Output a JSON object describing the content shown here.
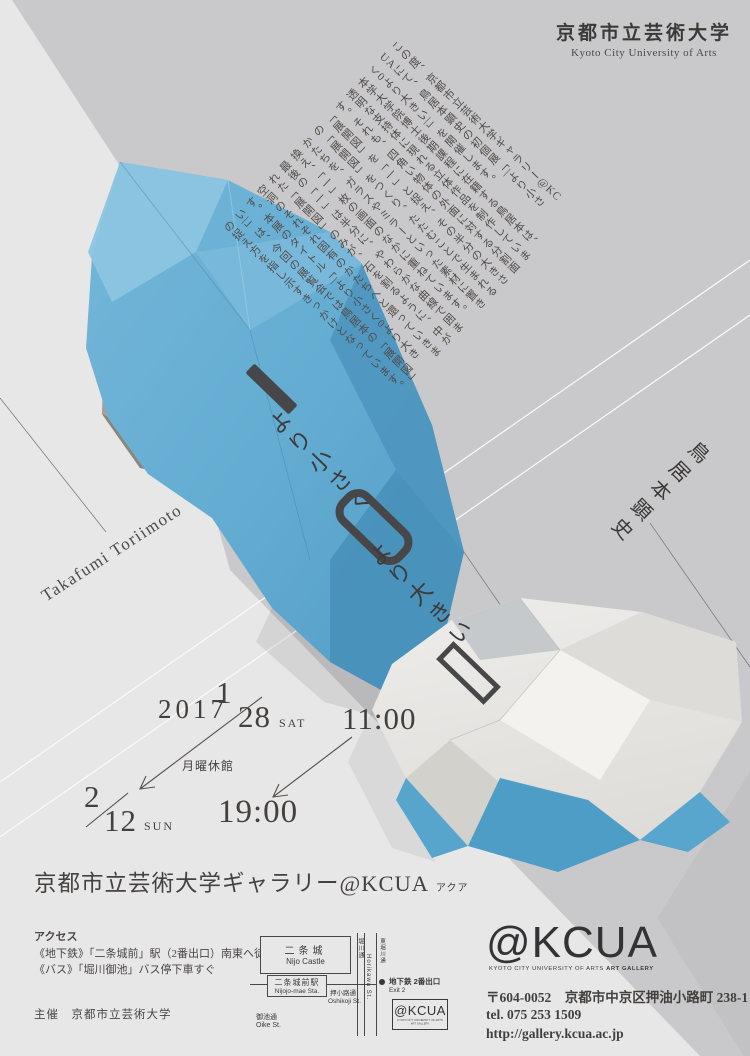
{
  "university": {
    "logo_ja": "京都市立芸術大学",
    "logo_en": "Kyoto City University of Arts"
  },
  "artist": {
    "name_ja": "鳥居本顕史",
    "name_en": "Takafumi Toriimoto"
  },
  "title": {
    "small": "より小さく",
    "large": "より大きい",
    "ring_glyph": "0",
    "bar_glyph": "|"
  },
  "statement": {
    "text": "この度、京都市立芸術大学ギャラリー@KC\nUAにて、鳥居本顕史の初個展「|より小さ\nく0より大きい|」を開催します。\n本学大学院博士後期課程に在籍する鳥居本は、\n透明な支持体に現れる立体作品を制作していま\nす。それも、四角い物体の外面に対する分割面\n「展開図」を「一」と捉え、その半分の大きさ\nの「展開図」をつくり、たたむことで生まれる\nかたちを、ガラスやミラーといった素材に置き\n換え、「一」枚の画面のなかに重ねています。\n最後の「一」は半分に、やわらかな曲線で囲ま\nれた「展開図」のみが、石を割るように、中が\n空洞のそれぞれ固有のかたちへと還っていきま\nす。本展のタイトル「|より小さく0より大き\nい|」は、今回の展覧会では鳥居本の「展開図」\nの捉え方を指し示すきっかけとなっています。"
  },
  "dates": {
    "year": "2017",
    "start_month": "1",
    "start_day": "28",
    "start_dow": "SAT",
    "open_time": "11:00",
    "closed_note": "月曜休館",
    "end_month": "2",
    "end_day": "12",
    "end_dow": "SUN",
    "close_time": "19:00"
  },
  "venue": {
    "name": "京都市立芸術大学ギャラリー@KCUA",
    "ruby": "アクア"
  },
  "access": {
    "heading": "アクセス",
    "lines": [
      "《地下鉄》「二条城前」駅（2番出口）南東へ徒歩約3分",
      "《バス》「堀川御池」バス停下車すぐ"
    ],
    "organizer": "主催　京都市立芸術大学"
  },
  "map": {
    "castle_ja": "二条城",
    "castle_en": "Nijo Castle",
    "station_ja": "二条城前駅",
    "station_en": "Nijojo-mae Sta.",
    "road_horikawa_ja": "堀川通",
    "road_horikawa_en": "Horikawa St.",
    "road_higashihorikawa_ja": "東堀川通",
    "street_oshikoji_ja": "押小路通",
    "street_oshikoji_en": "Oshikoji St.",
    "street_oike_ja": "御池通",
    "street_oike_en": "Oike St.",
    "exit_ja": "地下鉄 2番出口",
    "exit_en": "Exit 2",
    "kcua_label": "@KCUA",
    "kcua_sub": "KYOTO CITY UNIVERSITY OF ARTS ART GALLERY"
  },
  "footer": {
    "logo": "@KCUA",
    "logo_sub1": "KYOTO CITY UNIVERSITY OF ARTS ",
    "logo_sub2": "ART GALLERY",
    "address": "〒604-0052　京都市中京区押油小路町 238-1",
    "tel": "tel. 075 253 1509",
    "url": "http://gallery.kcua.ac.jp"
  },
  "colors": {
    "background": "#e7e7e8",
    "gray_band": "#c9c9cb",
    "corner_band": "#c2c2c4",
    "paper_blue": "#63abd1",
    "paper_tan": "#a6a095",
    "paper_white": "#e9e8e5",
    "ink": "#44403e"
  }
}
